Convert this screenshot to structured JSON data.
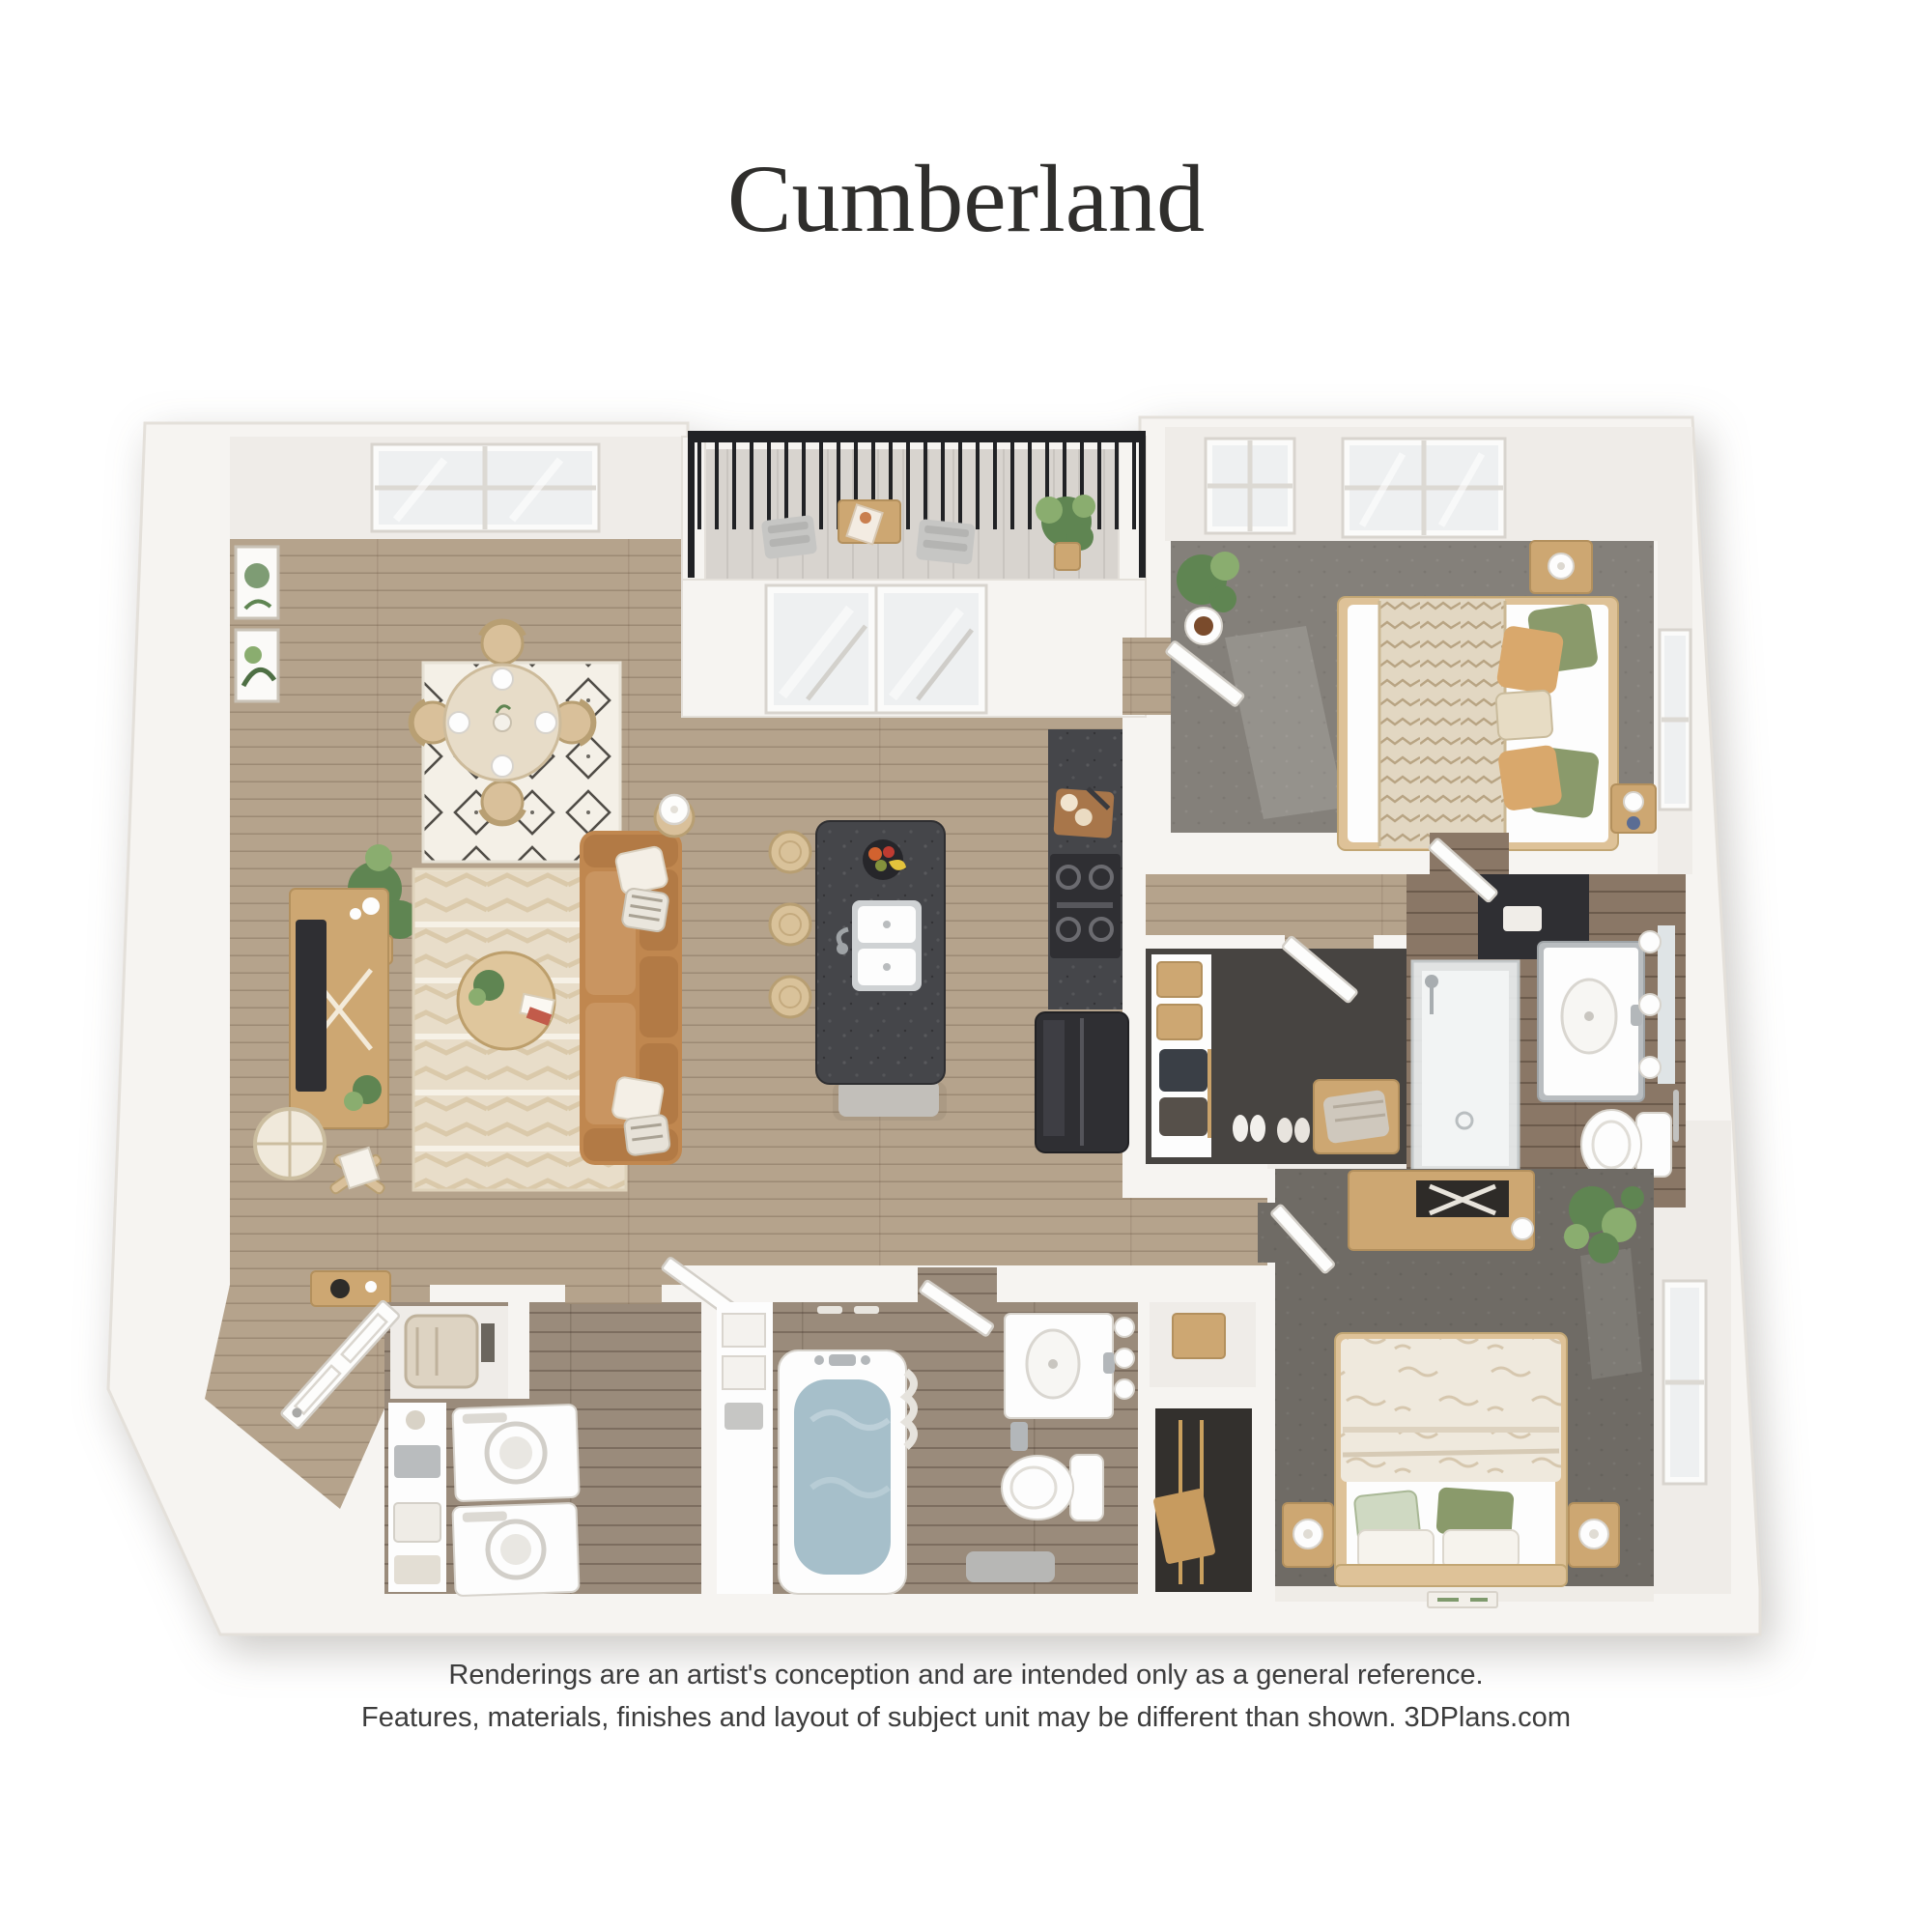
{
  "title": "Cumberland",
  "disclaimer": {
    "line1": "Renderings are an artist's conception and are intended only as a general reference.",
    "line2": "Features, materials, finishes and layout of subject unit may be different than shown. 3DPlans.com"
  },
  "palette": {
    "wall": "#f6f4f1",
    "wall_edge": "#e4e0da",
    "wall_face": "#efece8",
    "wood": "#b5a38c",
    "wood_dark": "#9a8b7b",
    "tile_warm": "#8a7766",
    "balcony_floor": "#d8d4cf",
    "carpet_primary": "#84807a",
    "carpet_secondary": "#6f6b65",
    "carpet_closet": "#474441",
    "rug_living": "#e8ddc9",
    "rug_dining": "#f4f0e7",
    "sofa": "#c0874f",
    "wood_furniture": "#cda772",
    "wood_light": "#dec298",
    "island": "#45464a",
    "appliance_dark": "#2f2f33",
    "railing": "#212225",
    "plant": "#5f8552",
    "plant_light": "#8aad6f",
    "water": "#a6bfca",
    "fixture": "#fdfdfd",
    "glass": "#eef0f1",
    "bed_linen": "#efe9dd",
    "pillow_green": "#8a9a6b",
    "pillow_tan": "#d9a86c",
    "text": "#2f2e2c",
    "disclaimer_text": "#3c3c3c"
  }
}
